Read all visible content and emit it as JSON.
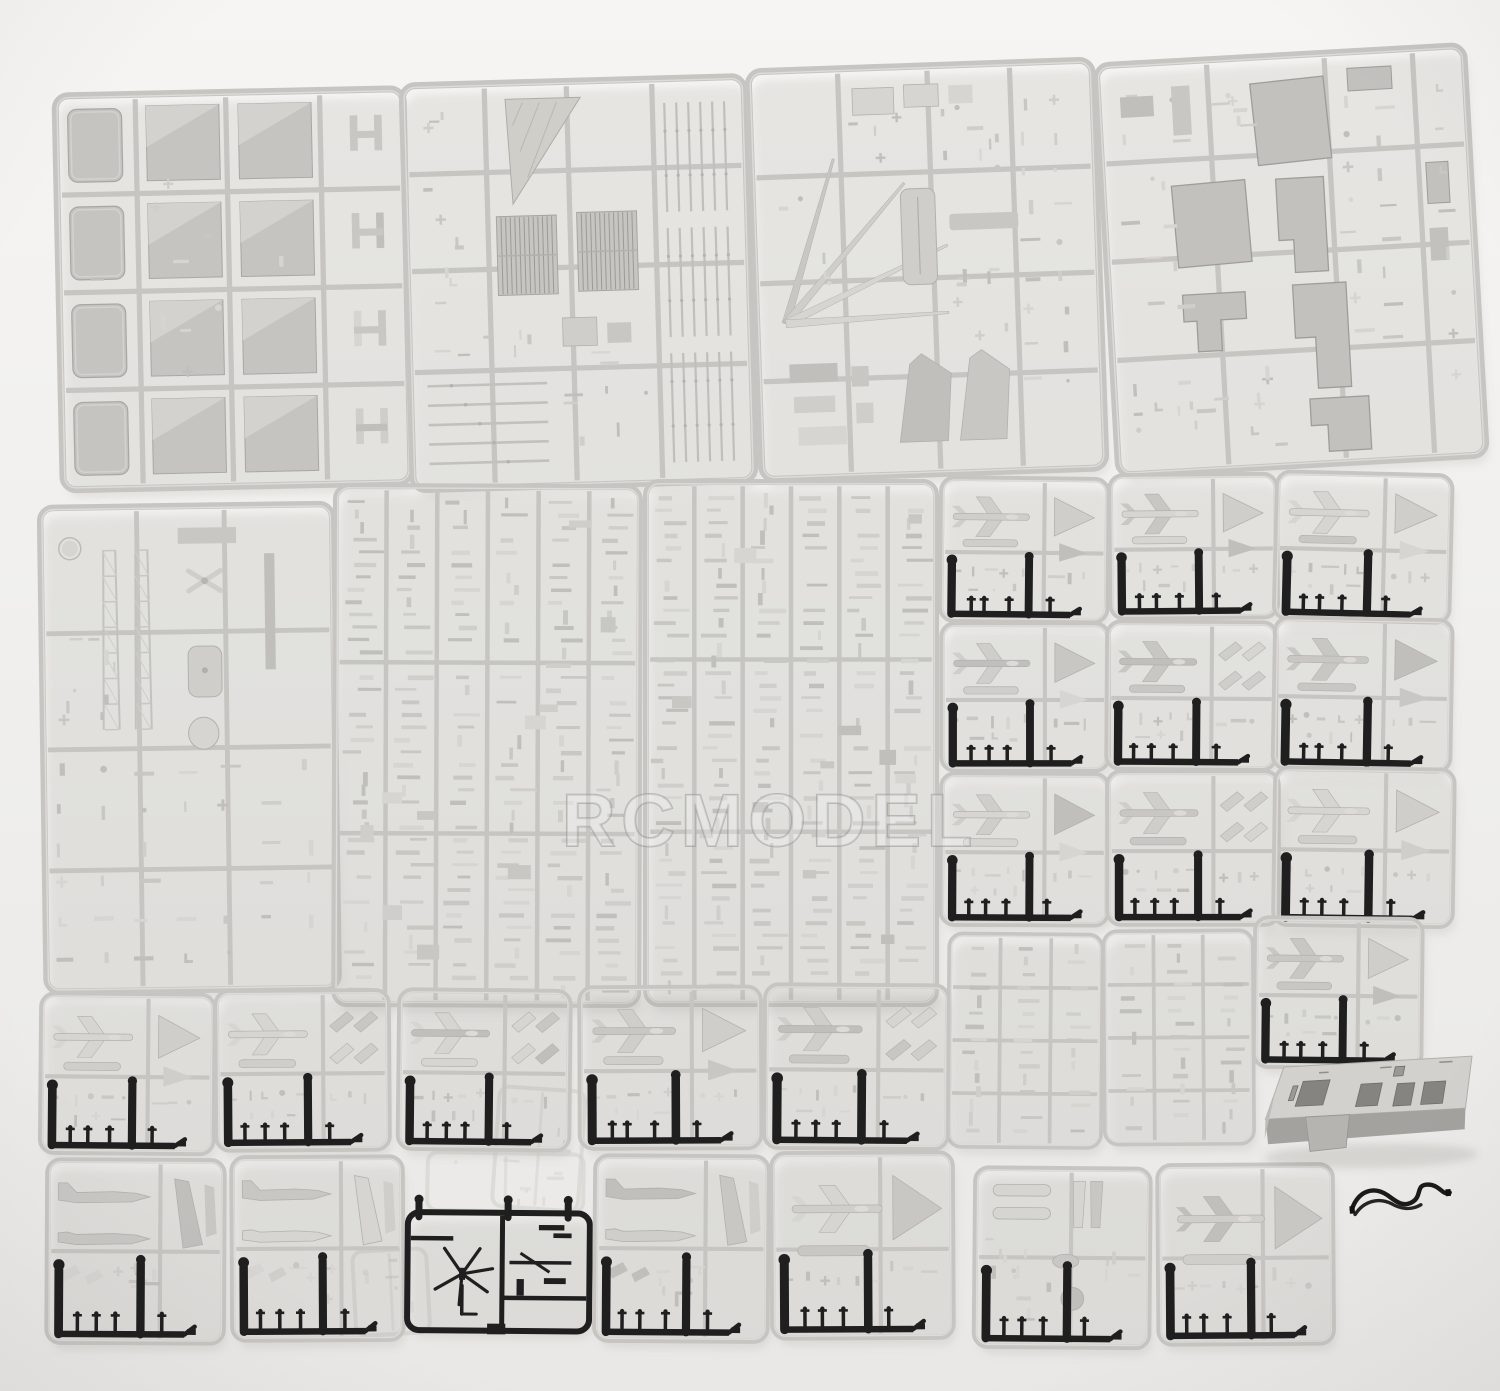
{
  "title": "Plastic model kit sprues product photo",
  "watermark": {
    "text": "RCMODEL"
  },
  "palette": {
    "background_top": "#f6f5f3",
    "background_bottom": "#e9e8e6",
    "sprue_frame": "#c6c5c2",
    "sprue_frame_light": "#e2e1de",
    "part_fills": [
      "#d6d5d2",
      "#cfcecb",
      "#c8c7c4",
      "#c0bfbc"
    ],
    "part_edge": "#b2b1ae",
    "panel_fill": "#c5c4c0",
    "panel_highlight": "#d3d2ce",
    "panel_edge": "#a8a7a4",
    "large_part_fill": "#c2c1be",
    "large_part_edge": "#9e9d9a",
    "black_plastic": "#1f1f1f",
    "shadow": "rgba(120,120,114,0.13)",
    "watermark_fill": "rgba(255,255,255,0.42)",
    "watermark_stroke": "#8d8d8b"
  },
  "scene": {
    "width": 1500,
    "height": 1391,
    "sprues": [
      {
        "id": "deck-panels-sprue",
        "kind": "panels",
        "x": 55,
        "y": 96,
        "w": 348,
        "h": 394,
        "rot": -1.2,
        "seed": 11
      },
      {
        "id": "grating-sprue",
        "kind": "gratings",
        "x": 402,
        "y": 86,
        "w": 342,
        "h": 404,
        "rot": -1.6,
        "seed": 12
      },
      {
        "id": "fittings-sprue-large",
        "kind": "mixed",
        "x": 748,
        "y": 72,
        "w": 344,
        "h": 408,
        "rot": -2,
        "seed": 13
      },
      {
        "id": "hull-parts-sprue",
        "kind": "hull",
        "x": 1096,
        "y": 66,
        "w": 368,
        "h": 410,
        "rot": -3.2,
        "seed": 14
      },
      {
        "id": "details-sprue",
        "kind": "medium",
        "x": 40,
        "y": 508,
        "w": 292,
        "h": 484,
        "rot": -0.8,
        "seed": 15
      },
      {
        "id": "tiny-parts-sprue-a",
        "kind": "dense",
        "x": 336,
        "y": 486,
        "w": 304,
        "h": 518,
        "rot": 0.2,
        "seed": 16
      },
      {
        "id": "tiny-parts-sprue-b",
        "kind": "dense",
        "x": 646,
        "y": 482,
        "w": 290,
        "h": 522,
        "rot": 0,
        "seed": 17
      },
      {
        "id": "aircraft-sprue-1",
        "kind": "aircraft",
        "x": 942,
        "y": 478,
        "w": 166,
        "h": 142,
        "rot": 0.6,
        "seed": 21,
        "gear": true
      },
      {
        "id": "aircraft-sprue-2",
        "kind": "aircraft",
        "x": 1110,
        "y": 476,
        "w": 166,
        "h": 142,
        "rot": -0.5,
        "seed": 22,
        "gear": true
      },
      {
        "id": "aircraft-sprue-3",
        "kind": "aircraft",
        "x": 1278,
        "y": 472,
        "w": 174,
        "h": 146,
        "rot": 1.4,
        "seed": 23,
        "gear": true
      },
      {
        "id": "aircraft-sprue-4",
        "kind": "aircraft",
        "x": 942,
        "y": 624,
        "w": 166,
        "h": 146,
        "rot": 0,
        "seed": 24,
        "gear": true
      },
      {
        "id": "aircraft-sprue-5",
        "kind": "aircraft",
        "x": 1108,
        "y": 622,
        "w": 168,
        "h": 146,
        "rot": 0.4,
        "seed": 25,
        "gear": true
      },
      {
        "id": "aircraft-sprue-6",
        "kind": "aircraft",
        "x": 1276,
        "y": 618,
        "w": 176,
        "h": 150,
        "rot": 1,
        "seed": 26,
        "gear": true
      },
      {
        "id": "aircraft-sprue-7",
        "kind": "aircraft",
        "x": 942,
        "y": 774,
        "w": 166,
        "h": 150,
        "rot": 0.3,
        "seed": 27,
        "gear": true
      },
      {
        "id": "aircraft-sprue-8",
        "kind": "aircraft",
        "x": 1108,
        "y": 772,
        "w": 170,
        "h": 152,
        "rot": 0,
        "seed": 28,
        "gear": true
      },
      {
        "id": "aircraft-sprue-9",
        "kind": "aircraft",
        "x": 1276,
        "y": 768,
        "w": 178,
        "h": 156,
        "rot": 0.8,
        "seed": 29,
        "gear": true
      },
      {
        "id": "railing-sprue-a",
        "kind": "denseTall",
        "x": 950,
        "y": 934,
        "w": 152,
        "h": 212,
        "rot": 0.5,
        "seed": 31
      },
      {
        "id": "railing-sprue-b",
        "kind": "denseTall",
        "x": 1104,
        "y": 932,
        "w": 148,
        "h": 212,
        "rot": -0.4,
        "seed": 32
      },
      {
        "id": "aircraft-sprue-10",
        "kind": "aircraft",
        "x": 1256,
        "y": 918,
        "w": 166,
        "h": 148,
        "rot": 0.6,
        "seed": 33,
        "gear": true
      },
      {
        "id": "clear-sprue-ghost-a",
        "kind": "ghost",
        "x": 500,
        "y": 1086,
        "w": 86,
        "h": 120,
        "rot": 4,
        "seed": 41
      },
      {
        "id": "clear-sprue-ghost-b",
        "kind": "ghost",
        "x": 352,
        "y": 1252,
        "w": 74,
        "h": 84,
        "rot": -3,
        "seed": 42
      },
      {
        "id": "clear-sprue-ghost-c",
        "kind": "ghost",
        "x": 428,
        "y": 1152,
        "w": 156,
        "h": 58,
        "rot": 1,
        "seed": 43
      },
      {
        "id": "aircraft-sprue-11",
        "kind": "aircraft",
        "x": 42,
        "y": 994,
        "w": 172,
        "h": 158,
        "rot": 0.5,
        "seed": 51,
        "gear": true
      },
      {
        "id": "aircraft-sprue-12",
        "kind": "aircraft",
        "x": 216,
        "y": 992,
        "w": 172,
        "h": 158,
        "rot": -0.4,
        "seed": 52,
        "gear": true
      },
      {
        "id": "aircraft-sprue-13",
        "kind": "aircraft",
        "x": 400,
        "y": 990,
        "w": 170,
        "h": 158,
        "rot": 0.6,
        "seed": 53,
        "gear": true
      },
      {
        "id": "aircraft-sprue-14",
        "kind": "aircraft",
        "x": 580,
        "y": 988,
        "w": 180,
        "h": 160,
        "rot": -0.2,
        "seed": 54,
        "gear": true
      },
      {
        "id": "aircraft-sprue-15",
        "kind": "aircraft",
        "x": 766,
        "y": 985,
        "w": 182,
        "h": 162,
        "rot": 0.4,
        "seed": 55,
        "gear": true
      },
      {
        "id": "jet-sprue-1",
        "kind": "jetSide",
        "x": 48,
        "y": 1160,
        "w": 176,
        "h": 182,
        "rot": 0.3,
        "seed": 61,
        "gear": true
      },
      {
        "id": "jet-sprue-2",
        "kind": "jetSide",
        "x": 232,
        "y": 1158,
        "w": 170,
        "h": 182,
        "rot": -0.3,
        "seed": 62,
        "gear": true
      },
      {
        "id": "rotor-sprue-black",
        "kind": "rotor",
        "x": 408,
        "y": 1212,
        "w": 182,
        "h": 118,
        "rot": 0.5,
        "seed": 63
      },
      {
        "id": "jet-sprue-3",
        "kind": "jetSide",
        "x": 596,
        "y": 1156,
        "w": 172,
        "h": 184,
        "rot": 0.4,
        "seed": 64,
        "gear": true
      },
      {
        "id": "aircraft-sprue-16",
        "kind": "aircraftBig",
        "x": 772,
        "y": 1154,
        "w": 180,
        "h": 184,
        "rot": -0.3,
        "seed": 65,
        "gear": true
      },
      {
        "id": "stores-sprue",
        "kind": "pods",
        "x": 976,
        "y": 1168,
        "w": 174,
        "h": 178,
        "rot": 0.5,
        "seed": 66,
        "gear": true
      },
      {
        "id": "aircraft-sprue-17",
        "kind": "aircraftBig",
        "x": 1158,
        "y": 1166,
        "w": 174,
        "h": 178,
        "rot": -0.4,
        "seed": 67,
        "gear": true
      },
      {
        "id": "display-base-part",
        "kind": "box",
        "x": 1258,
        "y": 1058,
        "w": 214,
        "h": 96,
        "rot": -1,
        "seed": 71
      },
      {
        "id": "black-wire",
        "kind": "wire",
        "x": 1348,
        "y": 1186,
        "w": 102,
        "h": 34,
        "rot": -4,
        "seed": 72
      }
    ]
  }
}
